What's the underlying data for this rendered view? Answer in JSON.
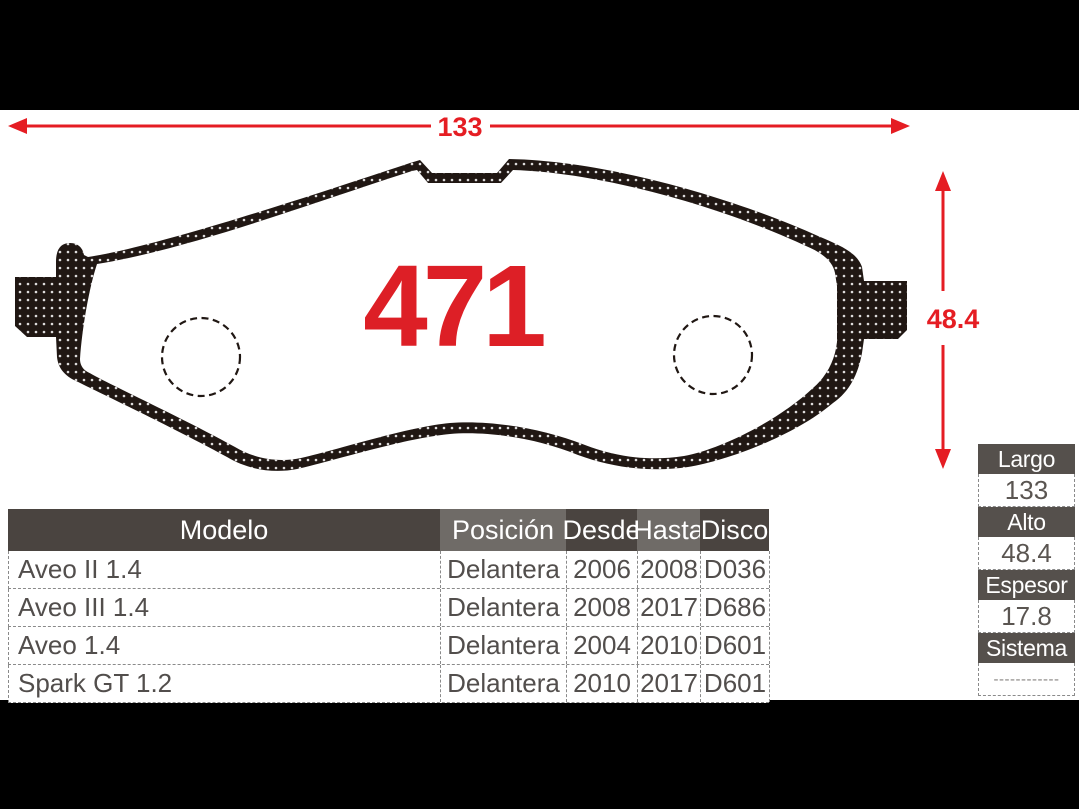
{
  "part_number": "471",
  "colors": {
    "accent_red": "#e51d23",
    "pad_black": "#201713",
    "header_dark": "#4a4440",
    "header_light": "#6f6b67",
    "specs_header": "#55504c"
  },
  "dimensions": {
    "width_label": "133",
    "height_label": "48.4"
  },
  "fitment_table": {
    "headers": [
      "Modelo",
      "Posición",
      "Desde",
      "Hasta",
      "Disco"
    ],
    "rows": [
      {
        "modelo": "Aveo II 1.4",
        "posicion": "Delantera",
        "desde": "2006",
        "hasta": "2008",
        "disco": "D036"
      },
      {
        "modelo": "Aveo III 1.4",
        "posicion": "Delantera",
        "desde": "2008",
        "hasta": "2017",
        "disco": "D686"
      },
      {
        "modelo": "Aveo 1.4",
        "posicion": "Delantera",
        "desde": "2004",
        "hasta": "2010",
        "disco": "D601"
      },
      {
        "modelo": "Spark GT 1.2",
        "posicion": "Delantera",
        "desde": "2010",
        "hasta": "2017",
        "disco": "D601"
      }
    ]
  },
  "specs_table": {
    "items": [
      {
        "label": "Largo",
        "value": "133"
      },
      {
        "label": "Alto",
        "value": "48.4"
      },
      {
        "label": "Espesor",
        "value": "17.8"
      },
      {
        "label": "Sistema",
        "value": "------------"
      }
    ]
  }
}
